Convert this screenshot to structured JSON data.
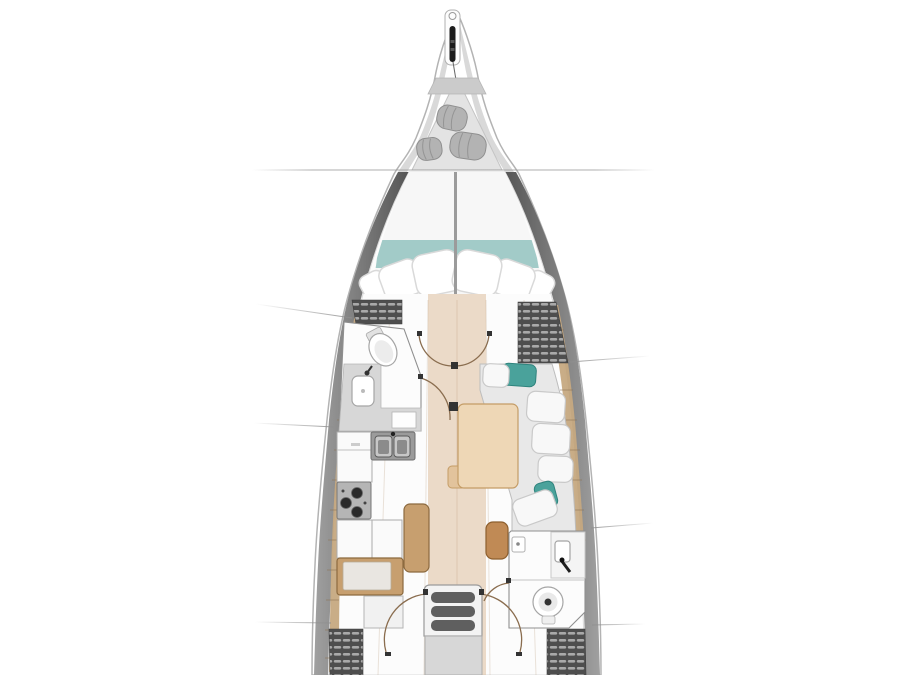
{
  "title": "sailboat-interior-floor-plan",
  "palette": {
    "background": "#ffffff",
    "hullStroke": "#b3b3b3",
    "hullBandDark": "#555555",
    "hullBandLight": "#9c9c9c",
    "bowBand": "#d9d9d9",
    "interior": "#fcfcfc",
    "lockerGray": "#e3e3e3",
    "lidGray": "#cbcbcb",
    "fender": "#b3b3b3",
    "bedTeal": "#a2cbc8",
    "pillow": "#ffffff",
    "headboardWood": "#c7a77f",
    "floorWood": "#c59d73",
    "floorLight": "#d7b189",
    "deckWood": "#c6a981",
    "hatchDark": "#4e4e4e",
    "hatchSlat": "#a9a9a9",
    "counterWhite": "#fafafa",
    "counterGray": "#d7d7d7",
    "sinkSteel": "#c7c7c7",
    "stoveGray": "#b5b5b5",
    "burnerBlack": "#2a2a2a",
    "benchWood": "#c79f6f",
    "benchBorder": "#8c6a3f",
    "tableWood": "#eed7b6",
    "tableBorder": "#c49c66",
    "tableLeaf": "#e2c39c",
    "poufWood": "#c08a55",
    "poufBorder": "#8d5f2e",
    "sofaGray": "#e8e8e8",
    "cushionWhite": "#f8f8f8",
    "cushionTeal": "#4aa29b",
    "bathWhite": "#fcfcfc",
    "fixtureStroke": "#a5a5a5",
    "doorArc": "#8a6d4f",
    "post": "#333333",
    "leaderLine": "#9a9a9a",
    "stepsFrame": "#f3f3f3",
    "stepSlot": "#5f5f5f",
    "platform": "#d7d7d7"
  },
  "regions": [
    {
      "name": "bowsprit-anchor-roller"
    },
    {
      "name": "bow-sail-locker-with-fenders"
    },
    {
      "name": "forward-cabin-v-berth"
    },
    {
      "name": "forward-head-bathroom"
    },
    {
      "name": "galley"
    },
    {
      "name": "saloon-dinette"
    },
    {
      "name": "chart-table-settee"
    },
    {
      "name": "aft-head-bathroom"
    },
    {
      "name": "companionway-steps"
    },
    {
      "name": "aft-storage-lockers"
    },
    {
      "name": "callout-leader-lines"
    }
  ]
}
